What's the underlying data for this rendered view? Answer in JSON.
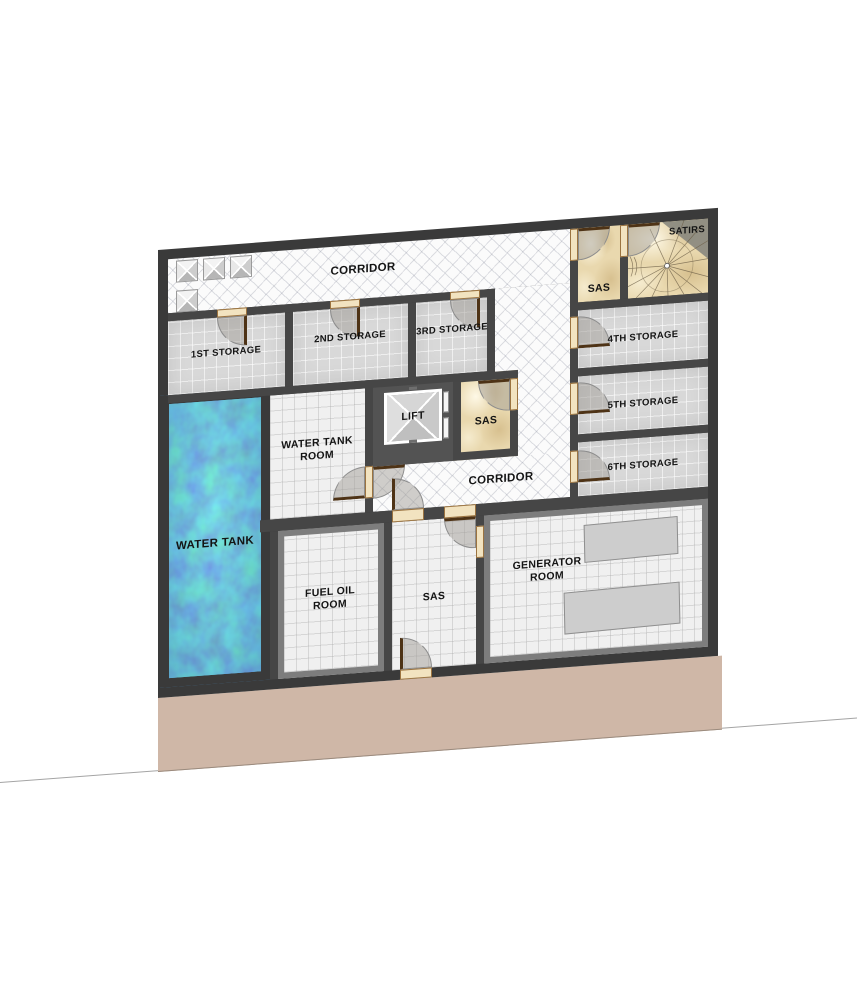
{
  "plan": {
    "type": "basement-floor-plan",
    "colors": {
      "wall": "#464646",
      "terrain": "#cfb7a7",
      "water": "#4e8fc4",
      "marble": "#e9d8ae",
      "corridor_tile": "#fbfbfb",
      "storage_tile": "#d8d8d8",
      "door_leaf": "#4e3316",
      "threshold": "#f2e3c0"
    }
  },
  "labels": {
    "corridor_top": "CORRIDOR",
    "corridor_lower": "CORRIDOR",
    "storage_1": "1ST STORAGE",
    "storage_2": "2ND STORAGE",
    "storage_3": "3RD STORAGE",
    "storage_4": "4TH STORAGE",
    "storage_5": "5TH STORAGE",
    "storage_6": "6TH STORAGE",
    "stairs": "SATIRS",
    "sas_top": "SAS",
    "sas_mid": "SAS",
    "sas_lower": "SAS",
    "lift": "LIFT",
    "water_tank": "WATER TANK",
    "water_tank_room": "WATER TANK\nROOM",
    "fuel_oil_room": "FUEL OIL\nROOM",
    "generator_room": "GENERATOR\nROOM"
  }
}
